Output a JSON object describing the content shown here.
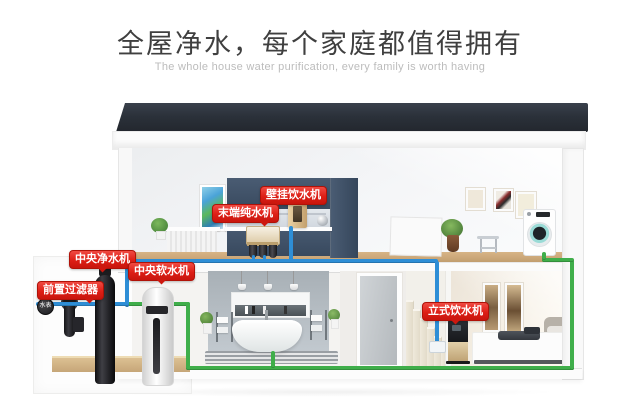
{
  "header": {
    "title": "全屋净水，每个家庭都值得拥有",
    "subtitle": "The whole house water purification, every family is worth having"
  },
  "callouts": {
    "wall_dispenser": "壁挂饮水机",
    "terminal_purifier": "末端纯水机",
    "central_purifier": "中央净水机",
    "central_softener": "中央软水机",
    "pre_filter": "前置过滤器",
    "water_meter": "水表",
    "standing_dispenser": "立式饮水机"
  },
  "colors": {
    "callout_red": "#dd1f16",
    "pipe_blue": "#2e8ed6",
    "pipe_green": "#3fae4a",
    "roof_dark": "#2b313a",
    "kitchen_cabinet_navy": "#3d4f66",
    "wood_floor": "#c9a474"
  }
}
